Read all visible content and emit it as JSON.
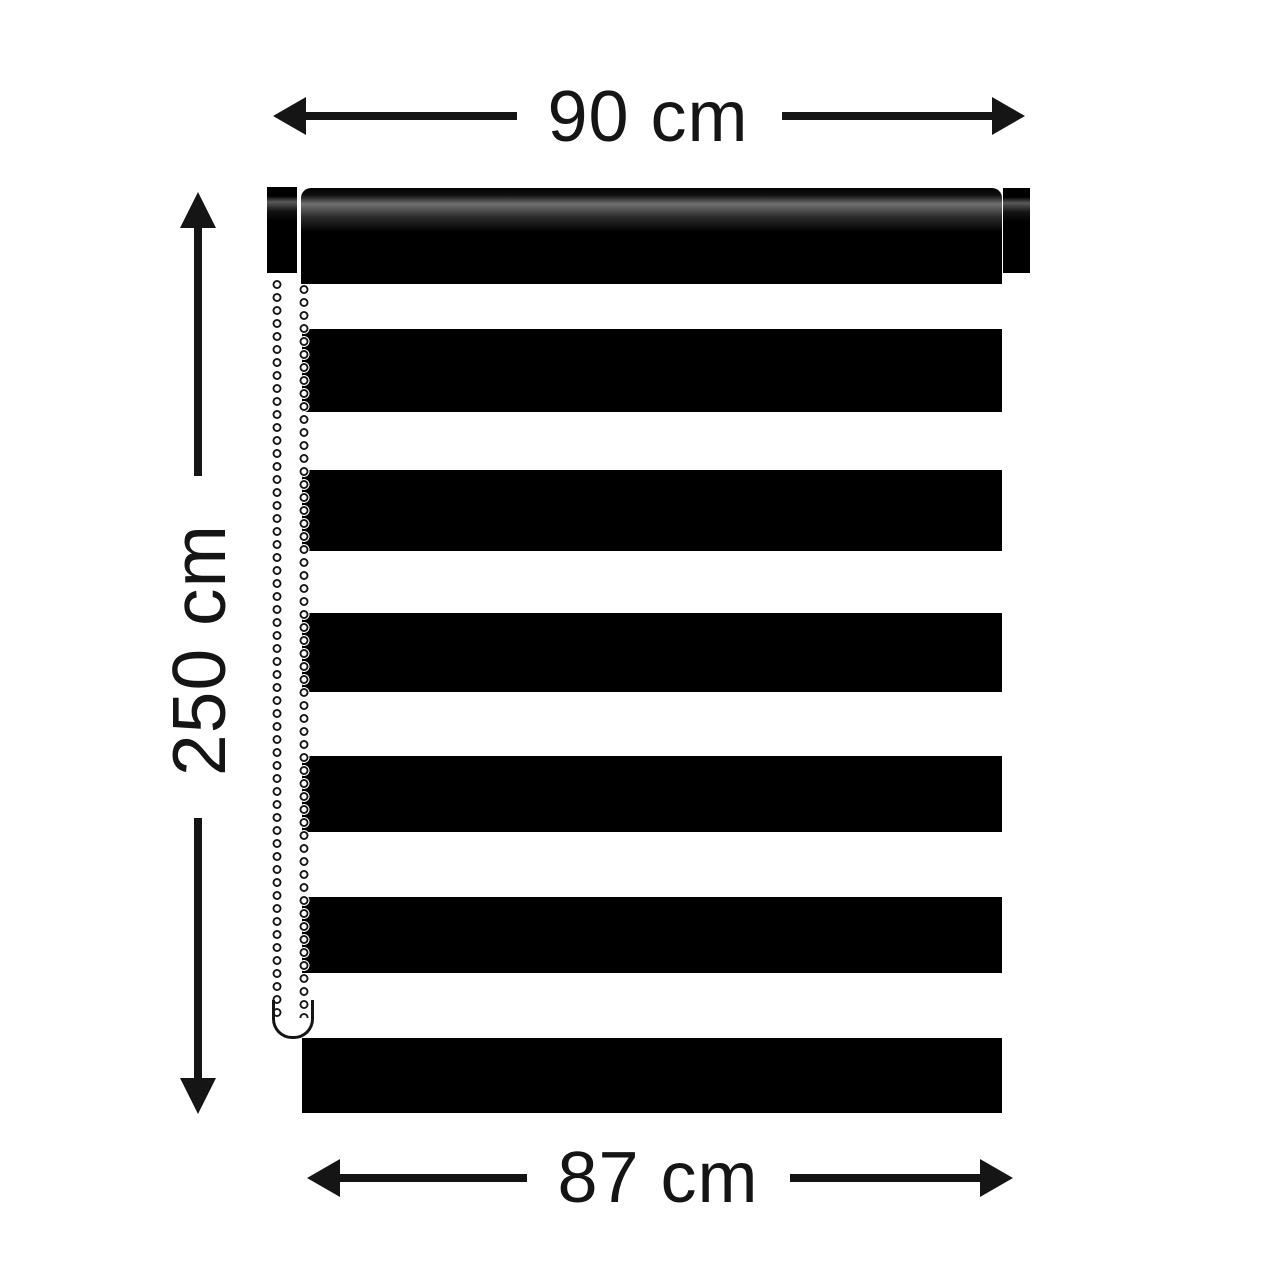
{
  "canvas": {
    "width": 1280,
    "height": 1280,
    "background": "#ffffff"
  },
  "colors": {
    "ink": "#151515",
    "blind": "#000000",
    "background": "#ffffff"
  },
  "dimensions": {
    "top": {
      "label": "90 cm",
      "value": 90,
      "unit": "cm"
    },
    "left": {
      "label": "250 cm",
      "value": 250,
      "unit": "cm"
    },
    "bottom": {
      "label": "87 cm",
      "value": 87,
      "unit": "cm"
    }
  },
  "blind": {
    "black_stripe_count": 7,
    "white_gap_count": 6,
    "middle_black_stripes": [
      {
        "top": 329,
        "height": 83
      },
      {
        "top": 470,
        "height": 81
      },
      {
        "top": 613,
        "height": 79
      },
      {
        "top": 756,
        "height": 76
      },
      {
        "top": 897,
        "height": 76
      }
    ]
  }
}
